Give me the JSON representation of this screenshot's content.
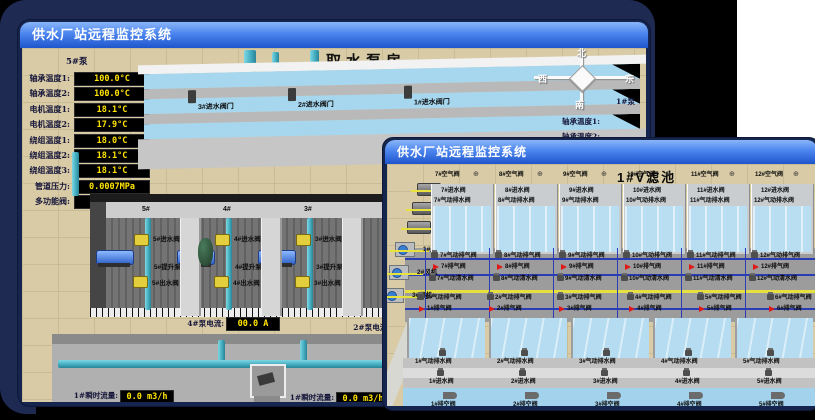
{
  "back_window": {
    "title": "供水厂站远程监控系统",
    "scene_title": "取水泵房",
    "pump_panel": {
      "title": "5#泵",
      "rows": [
        {
          "label": "轴承温度1:",
          "value": "100.0°C"
        },
        {
          "label": "轴承温度2:",
          "value": "100.0°C"
        },
        {
          "label": "电机温度1:",
          "value": "18.1°C"
        },
        {
          "label": "电机温度2:",
          "value": "17.9°C"
        },
        {
          "label": "绕组温度1:",
          "value": "18.0°C"
        },
        {
          "label": "绕组温度2:",
          "value": "18.1°C"
        },
        {
          "label": "绕组温度3:",
          "value": "18.1°C"
        },
        {
          "label": "管道压力:",
          "value": "0.0007MPa"
        },
        {
          "label": "多功能阀:",
          "value": "0%"
        }
      ]
    },
    "inlet_valves": [
      "3#进水阀门",
      "2#进水阀门",
      "1#进水阀门"
    ],
    "compass": {
      "north": "北",
      "south": "南",
      "east": "东",
      "west": "西"
    },
    "right_panel": {
      "title": "1#泵",
      "rows": [
        "轴承温度1:",
        "轴承温度2:"
      ]
    },
    "hall_sections": [
      {
        "id": "5#",
        "inlet": "5#进水阀",
        "pump": "5#提升泵",
        "outlet": "5#出水阀"
      },
      {
        "id": "4#",
        "inlet": "4#进水阀",
        "pump": "4#提升泵",
        "outlet": "4#出水阀"
      },
      {
        "id": "3#",
        "inlet": "3#进水阀",
        "pump": "3#提升泵",
        "outlet": "3#出水阀"
      }
    ],
    "currents": [
      {
        "label": "4#泵电流:",
        "value": "00.0 A"
      },
      {
        "label": "2#泵电流:",
        "value": ""
      }
    ],
    "flows": [
      {
        "label": "1#瞬时流量:",
        "value": "0.0 m3/h"
      },
      {
        "label": "1#瞬时流量:",
        "value": "0.0 m3/h"
      }
    ]
  },
  "front_window": {
    "title": "供水厂站远程监控系统",
    "scene_title": "1#V滤池",
    "equipment": [
      "1#水泵",
      "2#水泵",
      "3#水泵",
      "1#风机",
      "2#风机",
      "3#风机"
    ],
    "top_cells": [
      {
        "air": "7#空气阀",
        "inlet": "7#进水阀",
        "drain": "7#气动排水阀",
        "exhaust": "7#气动排气阀",
        "vent": "7#排气阀",
        "clear": "7#气动清水阀"
      },
      {
        "air": "8#空气阀",
        "inlet": "8#进水阀",
        "drain": "8#气动排水阀",
        "exhaust": "8#气动排气阀",
        "vent": "8#排气阀",
        "clear": "8#气动清水阀"
      },
      {
        "air": "9#空气阀",
        "inlet": "9#进水阀",
        "drain": "9#气动排水阀",
        "exhaust": "9#气动排气阀",
        "vent": "9#排气阀",
        "clear": "9#气动清水阀"
      },
      {
        "air": "10#空气阀",
        "inlet": "10#进水阀",
        "drain": "10#气动排水阀",
        "exhaust": "10#气动排气阀",
        "vent": "10#排气阀",
        "clear": "10#气动清水阀"
      },
      {
        "air": "11#空气阀",
        "inlet": "11#进水阀",
        "drain": "11#气动排水阀",
        "exhaust": "11#气动排气阀",
        "vent": "11#排气阀",
        "clear": "11#气动清水阀"
      },
      {
        "air": "12#空气阀",
        "inlet": "12#进水阀",
        "drain": "12#气动排水阀",
        "exhaust": "12#气动排气阀",
        "vent": "12#排气阀",
        "clear": "12#气动清水阀"
      }
    ],
    "bottom_cells": [
      {
        "drain": "1#气动排水阀",
        "inlet": "1#进水阀",
        "empty": "1#排空阀",
        "exhaust": "1#气动排气阀",
        "vent": "1#排气阀"
      },
      {
        "drain": "2#气动排水阀",
        "inlet": "2#进水阀",
        "empty": "2#排空阀",
        "exhaust": "2#气动排气阀",
        "vent": "2#排气阀"
      },
      {
        "drain": "3#气动排水阀",
        "inlet": "3#进水阀",
        "empty": "3#排空阀",
        "exhaust": "3#气动排气阀",
        "vent": "3#排气阀"
      },
      {
        "drain": "4#气动排水阀",
        "inlet": "4#进水阀",
        "empty": "4#排空阀",
        "exhaust": "4#气动排气阀",
        "vent": "4#排气阀"
      },
      {
        "drain": "5#气动排水阀",
        "inlet": "5#进水阀",
        "empty": "5#排空阀",
        "exhaust": "5#气动排气阀",
        "vent": "5#排气阀"
      },
      {
        "drain": "6#气动排水阀",
        "inlet": "6#进水阀",
        "empty": "6#排空阀",
        "exhaust": "6#气动排气阀",
        "vent": "6#排气阀"
      }
    ]
  },
  "colors": {
    "backdrop_navy": "#1e2a52",
    "titlebar_top": "#8ab6f8",
    "titlebar_bottom": "#1f55cc",
    "lcd_bg": "#000000",
    "lcd_text": "#ffe400",
    "pipe_teal": "#3fa9bc",
    "valve_yellow": "#e3cf3e",
    "alarm_red": "#e01818",
    "water_blue": "#b5dcf0",
    "floor_beige": "#d8cba6"
  }
}
